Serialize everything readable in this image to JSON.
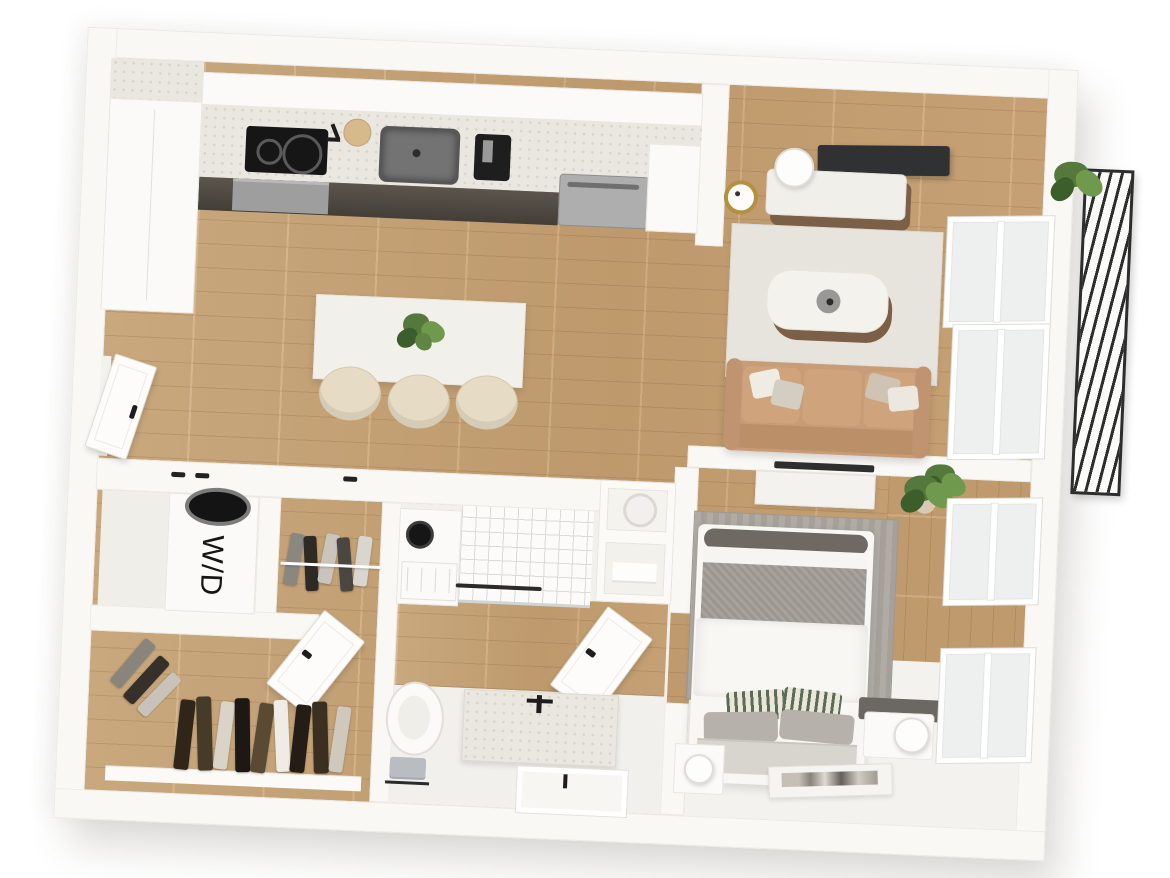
{
  "scene": {
    "type": "3d-floor-plan-render",
    "description": "Top-down 3D rendering of a one-bedroom apartment floor plan",
    "labels": {
      "washer_dryer": "W/D"
    },
    "rooms": [
      "kitchen",
      "dining-area",
      "living-room",
      "bedroom",
      "bathroom",
      "walk-in-closet",
      "coat-closet",
      "laundry-closet",
      "entry",
      "balcony"
    ],
    "palette": {
      "background": "#ffffff",
      "wall": "#f9f8f5",
      "wall_edge": "#eceae4",
      "wood_floor": "#cda97a",
      "white_floor": "#f2f0ec",
      "counter_terrazzo": "#eae7e0",
      "appliance_black": "#1f1f1f",
      "stainless_steel": "#a7a7a7",
      "sofa_tan": "#c59b75",
      "living_rug": "#e7e4dd",
      "bedroom_rug": "#a9a59e",
      "bed_blanket_gray": "#a39e97",
      "headboard_gray": "#d8d5cf",
      "plant_green": "#55793c",
      "balcony_railing": "#2d2d2d",
      "clock_brass": "#b4913f",
      "handle_black": "#222222"
    }
  }
}
